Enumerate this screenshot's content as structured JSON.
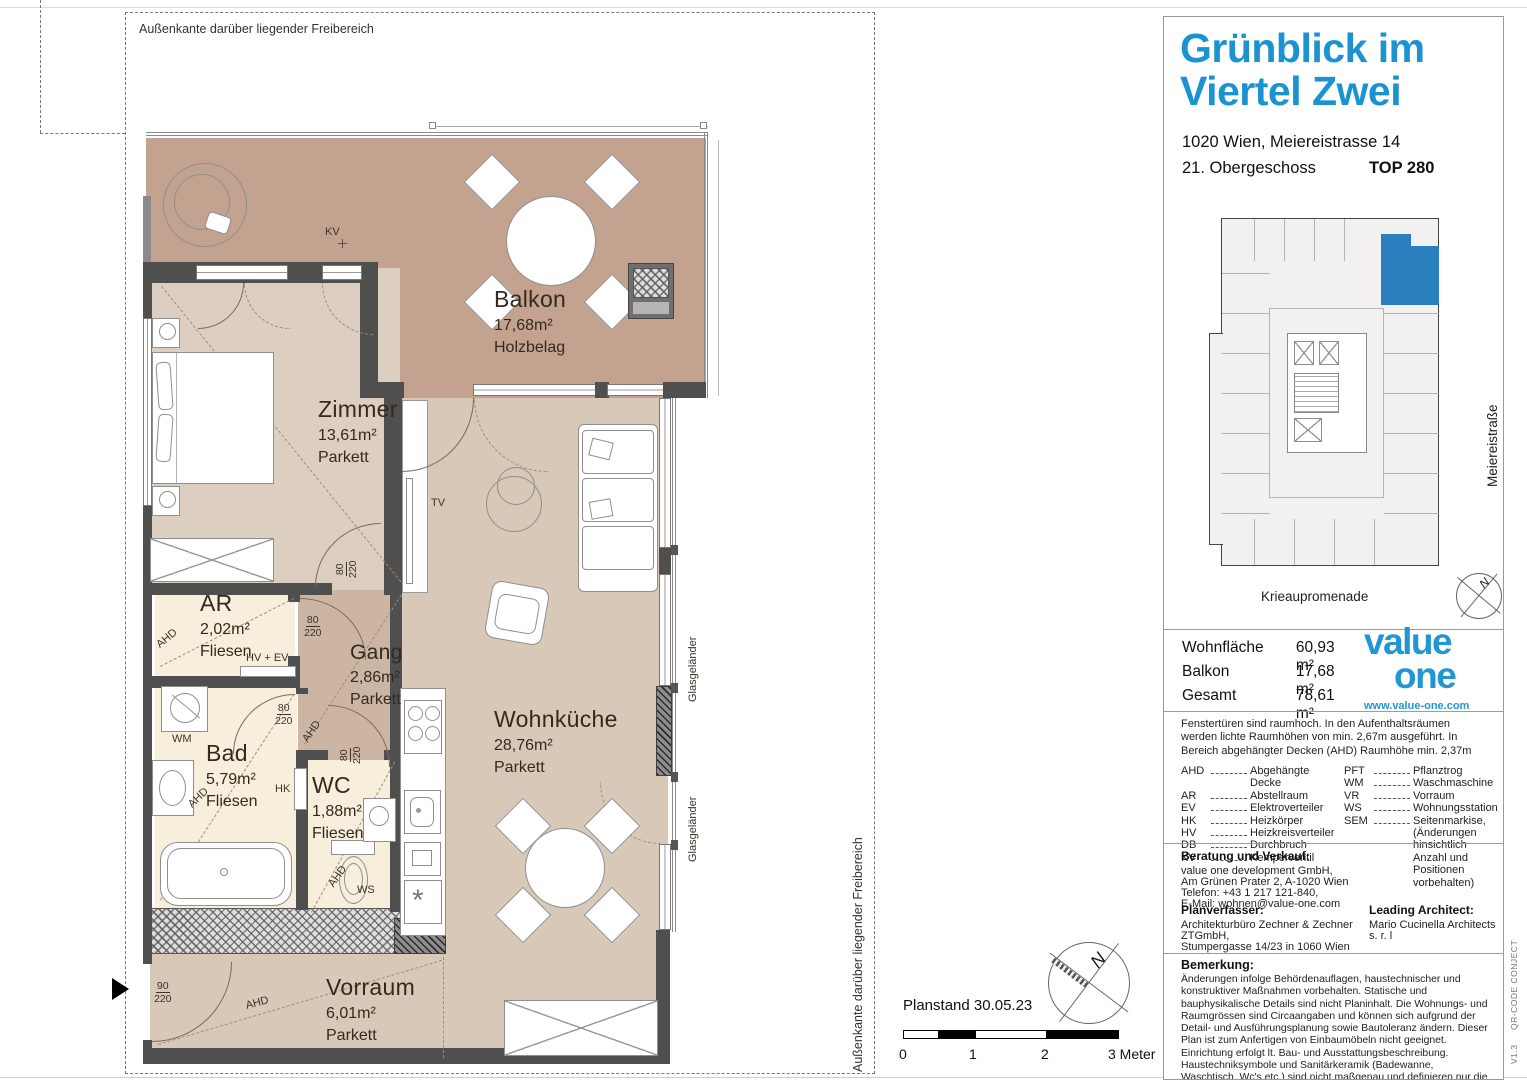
{
  "plan": {
    "boundary_label": "Außenkante darüber liegender Freibereich",
    "rooms": {
      "balkon": {
        "name": "Balkon",
        "area": "17,68m²",
        "floor": "Holzbelag"
      },
      "zimmer": {
        "name": "Zimmer",
        "area": "13,61m²",
        "floor": "Parkett"
      },
      "ar": {
        "name": "AR",
        "area": "2,02m²",
        "floor": "Fliesen"
      },
      "gang": {
        "name": "Gang",
        "area": "2,86m²",
        "floor": "Parkett"
      },
      "bad": {
        "name": "Bad",
        "area": "5,79m²",
        "floor": "Fliesen"
      },
      "wc": {
        "name": "WC",
        "area": "1,88m²",
        "floor": "Fliesen"
      },
      "wohnkueche": {
        "name": "Wohnküche",
        "area": "28,76m²",
        "floor": "Parkett"
      },
      "vorraum": {
        "name": "Vorraum",
        "area": "6,01m²",
        "floor": "Parkett"
      }
    },
    "ann": {
      "kv": "KV",
      "tv": "TV",
      "wm": "WM",
      "hk": "HK",
      "ws": "WS",
      "hv_ev": "HV + EV",
      "ahd": "AHD",
      "glas": "Glasgeländer",
      "d80": "80",
      "d220": "220",
      "d90": "90"
    },
    "scalebar": {
      "planstand": "Planstand 30.05.23",
      "t0": "0",
      "t1": "1",
      "t2": "2",
      "t3": "3 Meter"
    },
    "north": "N"
  },
  "panel": {
    "title1": "Grünblick im",
    "title2": "Viertel Zwei",
    "address": "1020 Wien, Meiereistrasse 14",
    "floor": "21. Obergeschoss",
    "unit": "TOP 280",
    "keyplan": {
      "street_bottom": "Krieaupromenade",
      "street_right": "Meiereistraße"
    },
    "areas": {
      "rows": [
        {
          "label": "Wohnfläche",
          "value": "60,93 m²"
        },
        {
          "label": "Balkon",
          "value": "17,68 m²"
        },
        {
          "label": "Gesamt",
          "value": "78,61 m²"
        }
      ]
    },
    "logo": {
      "word1": "value",
      "word2": "one",
      "url": "www.value-one.com"
    },
    "window_note": "Fenstertüren sind raumhoch. In den Aufenthaltsräumen werden lichte Raumhöhen von min. 2,67m ausgeführt. In Bereich abgehängter Decken (AHD) Raumhöhe min. 2,37m",
    "legend": {
      "left": [
        {
          "abbr": "AHD",
          "desc": "Abgehängte Decke"
        },
        {
          "abbr": "AR",
          "desc": "Abstellraum"
        },
        {
          "abbr": "EV",
          "desc": "Elektroverteiler"
        },
        {
          "abbr": "HK",
          "desc": "Heizkörper"
        },
        {
          "abbr": "HV",
          "desc": "Heizkreisverteiler"
        },
        {
          "abbr": "DB",
          "desc": "Durchbruch"
        },
        {
          "abbr": "KV",
          "desc": "Kemperventil"
        }
      ],
      "right": [
        {
          "abbr": "PFT",
          "desc": "Pflanztrog"
        },
        {
          "abbr": "WM",
          "desc": "Waschmaschine"
        },
        {
          "abbr": "VR",
          "desc": "Vorraum"
        },
        {
          "abbr": "WS",
          "desc": "Wohnungsstation"
        },
        {
          "abbr": "SEM",
          "desc": "Seitenmarkise, (Änderungen hinsichtlich Anzahl und Positionen vorbehalten)"
        }
      ]
    },
    "contact": {
      "heading": "Beratung und Verkauf:",
      "l1": "value one development GmbH,",
      "l2": "Am Grünen Prater 2, A-1020 Wien",
      "l3": "Telefon: +43 1 217 121-840,",
      "l4": "E-Mail: wohnen@value-one.com"
    },
    "planner": {
      "heading": "Planverfasser:",
      "l1": "Architekturbüro Zechner & Zechner ZTGmbH,",
      "l2": "Stumpergasse 14/23 in 1060 Wien"
    },
    "architect": {
      "heading": "Leading Architect:",
      "l1": "Mario Cucinella Architects s. r. l"
    },
    "remark": {
      "heading": "Bemerkung:",
      "text": "Änderungen infolge Behördenauflagen, haustechnischer und konstruktiver Maßnahmen vorbehalten. Statische und bauphysikalische Details sind nicht Planinhalt. Die Wohnungs- und Raumgrössen sind Circaangaben und können sich aufgrund der Detail- und Ausführungsplanung sowie Bautoleranz ändern. Dieser Plan ist zum Anfertigen von Einbaumöbeln nicht geeignet. Einrichtung erfolgt lt. Bau- und Ausstattungsbeschreibung. Haustechniksymbole und Sanitärkeramik (Badewanne, Waschtisch, Wc's etc.) sind nicht maßgenau und definieren nur die Lage. Einrichtungsgegenstände inkl. Küchen sind im Kaufpreis nicht inkludiert."
    },
    "edge": {
      "v1": "QR-CODE CONJECT",
      "v2": "V1.3"
    }
  },
  "colors": {
    "accent": "#1b93d0",
    "balcony": "#c3a390",
    "interior": "#dccfc2",
    "kitchen_room": "#d8c8b8",
    "gang": "#cdb5a3",
    "cream": "#f7eedb",
    "wall": "#4f4f4f",
    "highlight": "#2a7fbe"
  }
}
